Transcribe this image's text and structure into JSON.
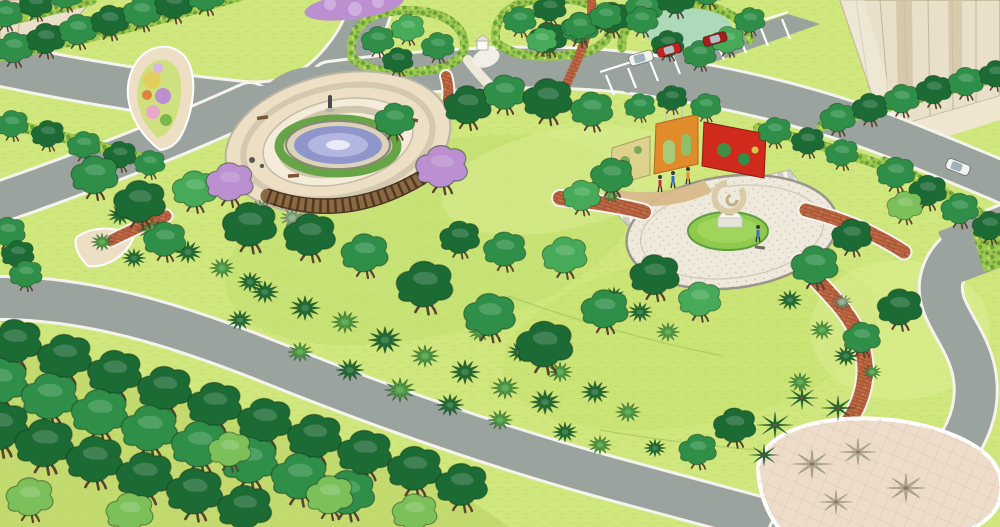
{
  "meta": {
    "domain": "landscape-architecture-render",
    "render_style": "sketchup-perspective-aerial",
    "image_width": 1000,
    "image_height": 527
  },
  "palette": {
    "white": "#f4f3ec",
    "road": "#9aa39d",
    "lawn": "#cfe77c",
    "lawnLight": "#dff09a",
    "lawnDark": "#b5d95f",
    "canopyDark": "#1c6b35",
    "canopyMid": "#2f8f48",
    "canopyBright": "#46aa58",
    "canopyLight": "#7cc05a",
    "canopyPale": "#a8d8c0",
    "trunk": "#5b4330",
    "hedge": "#9fc84e",
    "hedgeDark": "#5d9c3a",
    "shrubDark": "#226d36",
    "shrubMid": "#4f9e45",
    "shrubPale": "#8aa888",
    "shadow": "#a79e8b",
    "pavingTan": "#ecdfc4",
    "pavingLight": "#f4ecd9",
    "pavingRing": "#cfc6ae",
    "pavingGray": "#b7b2a2",
    "brick": "#bc6642",
    "brickLight": "#d08a5e",
    "water": "#8e96cc",
    "waterLight": "#b8bde4",
    "purple": "#bb8fd0",
    "purpleLight": "#d6b6e4",
    "pink": "#e8a8c8",
    "flowerYellow": "#e3cf5e",
    "wallCream": "#ddd28c",
    "wallOrange": "#e08c2a",
    "wallRed": "#cf2a1c",
    "sculpt": "#d9cba6",
    "sand": "#d8b98a",
    "building": "#e9e0ca",
    "buildingLine": "#b9ac8c",
    "buildingDark": "#cfc2a2",
    "carRed": "#c32323",
    "carDarkRed": "#a81d1d",
    "carWhite": "#f2f2ef",
    "plazaBottom": "#eddcca",
    "plazaGrid": "#d8c3ae"
  },
  "scene_elements": [
    {
      "name": "fountain-plaza",
      "desc": "circular paved plaza, round blue fountain with hedge ring, curved wooden pergola, teardrop flower bed, benches, small statue"
    },
    {
      "name": "sculpture-plaza",
      "desc": "oval paved plaza, ring sculpture on white pedestal in circular lawn, striped walkway, colorful perforated screen walls (cream, orange, red), sand play area with figures"
    },
    {
      "name": "south-plaza",
      "desc": "leaf-shaped paved plaza with diamond grid paving and palm shadows"
    },
    {
      "name": "ring-road",
      "desc": "grey loop road with white edge lines around the park"
    },
    {
      "name": "parking-bay",
      "desc": "white striped parking stalls with three parked cars"
    },
    {
      "name": "street-tree-rows",
      "desc": "hedge strips with evenly spaced street trees along roads"
    },
    {
      "name": "tree-grove",
      "desc": "dense staggered canopy-tree rows over light understory, bottom-left"
    },
    {
      "name": "office-building",
      "desc": "tall beige curtain-wall building, top-right corner"
    },
    {
      "name": "entry-building",
      "desc": "beige building corner, top-left"
    }
  ],
  "variant_colors": {
    "d": "canopyDark",
    "m": "canopyMid",
    "b": "canopyBright",
    "l": "canopyLight",
    "p": "shrubPale"
  },
  "vegetation": {
    "street_trees": [
      [
        14,
        50,
        0.8,
        "m"
      ],
      [
        46,
        41,
        0.8,
        "d"
      ],
      [
        78,
        32,
        0.8,
        "m"
      ],
      [
        110,
        23,
        0.8,
        "d"
      ],
      [
        142,
        14,
        0.8,
        "m"
      ],
      [
        174,
        6,
        0.8,
        "d"
      ],
      [
        206,
        -2,
        0.8,
        "m"
      ],
      [
        6,
        16,
        0.7,
        "m"
      ],
      [
        36,
        6,
        0.7,
        "d"
      ],
      [
        66,
        -3,
        0.7,
        "m"
      ],
      [
        12,
        126,
        0.7,
        "m"
      ],
      [
        48,
        136,
        0.7,
        "d"
      ],
      [
        84,
        147,
        0.7,
        "m"
      ],
      [
        120,
        157,
        0.7,
        "d"
      ],
      [
        150,
        165,
        0.65,
        "m"
      ],
      [
        8,
        234,
        0.75,
        "m"
      ],
      [
        18,
        256,
        0.7,
        "d"
      ],
      [
        26,
        276,
        0.7,
        "m"
      ],
      [
        548,
        40,
        0.8,
        "d"
      ],
      [
        580,
        30,
        0.8,
        "m"
      ],
      [
        612,
        20,
        0.8,
        "d"
      ],
      [
        644,
        10,
        0.8,
        "m"
      ],
      [
        676,
        1,
        0.8,
        "d"
      ],
      [
        708,
        -8,
        0.8,
        "m"
      ],
      [
        838,
        120,
        0.75,
        "m"
      ],
      [
        870,
        110,
        0.75,
        "d"
      ],
      [
        902,
        101,
        0.75,
        "m"
      ],
      [
        934,
        92,
        0.75,
        "d"
      ],
      [
        966,
        84,
        0.75,
        "m"
      ],
      [
        996,
        76,
        0.7,
        "d"
      ],
      [
        896,
        175,
        0.8,
        "m"
      ],
      [
        928,
        193,
        0.8,
        "d"
      ],
      [
        960,
        211,
        0.8,
        "m"
      ],
      [
        990,
        228,
        0.75,
        "d"
      ],
      [
        378,
        42,
        0.7,
        "m"
      ],
      [
        408,
        30,
        0.7,
        "b"
      ],
      [
        438,
        48,
        0.7,
        "m"
      ],
      [
        398,
        62,
        0.65,
        "d"
      ],
      [
        520,
        22,
        0.7,
        "m"
      ],
      [
        550,
        10,
        0.7,
        "d"
      ],
      [
        580,
        28,
        0.7,
        "m"
      ],
      [
        542,
        42,
        0.65,
        "b"
      ],
      [
        606,
        18,
        0.7,
        "m"
      ],
      [
        642,
        22,
        0.7,
        "m"
      ],
      [
        668,
        46,
        0.7,
        "d"
      ],
      [
        700,
        56,
        0.7,
        "m"
      ],
      [
        728,
        42,
        0.7,
        "b"
      ],
      [
        750,
        22,
        0.65,
        "m"
      ],
      [
        775,
        133,
        0.7,
        "m"
      ],
      [
        808,
        143,
        0.7,
        "d"
      ],
      [
        842,
        155,
        0.7,
        "m"
      ]
    ],
    "park_trees": [
      [
        468,
        108,
        1,
        "d"
      ],
      [
        505,
        95,
        0.9,
        "m"
      ],
      [
        548,
        102,
        1.05,
        "d"
      ],
      [
        592,
        112,
        0.9,
        "m"
      ],
      [
        395,
        122,
        0.85,
        "m"
      ],
      [
        640,
        108,
        0.65,
        "m"
      ],
      [
        672,
        100,
        0.65,
        "d"
      ],
      [
        706,
        108,
        0.65,
        "m"
      ],
      [
        95,
        178,
        1,
        "m"
      ],
      [
        140,
        205,
        1.1,
        "d"
      ],
      [
        195,
        192,
        0.95,
        "b"
      ],
      [
        250,
        228,
        1.15,
        "d"
      ],
      [
        165,
        242,
        0.9,
        "m"
      ],
      [
        310,
        238,
        1.1,
        "d"
      ],
      [
        365,
        256,
        1,
        "m"
      ],
      [
        425,
        288,
        1.2,
        "d"
      ],
      [
        490,
        318,
        1.1,
        "m"
      ],
      [
        545,
        348,
        1.2,
        "d"
      ],
      [
        605,
        312,
        1,
        "m"
      ],
      [
        655,
        278,
        1.05,
        "d"
      ],
      [
        700,
        302,
        0.9,
        "b"
      ],
      [
        565,
        258,
        0.95,
        "b"
      ],
      [
        505,
        252,
        0.9,
        "m"
      ],
      [
        460,
        240,
        0.85,
        "d"
      ],
      [
        612,
        178,
        0.9,
        "m"
      ],
      [
        582,
        198,
        0.8,
        "b"
      ],
      [
        815,
        268,
        1,
        "m"
      ],
      [
        852,
        238,
        0.85,
        "d"
      ],
      [
        735,
        428,
        0.9,
        "d"
      ],
      [
        698,
        452,
        0.8,
        "m"
      ],
      [
        900,
        310,
        0.95,
        "d"
      ],
      [
        862,
        340,
        0.8,
        "m"
      ],
      [
        905,
        208,
        0.75,
        "l"
      ]
    ],
    "purple_trees": [
      [
        230,
        185,
        1
      ],
      [
        442,
        170,
        1.1
      ]
    ],
    "grove_trees": [
      [
        15,
        345,
        1.15,
        "d"
      ],
      [
        65,
        360,
        1.15,
        "d"
      ],
      [
        115,
        376,
        1.15,
        "d"
      ],
      [
        165,
        392,
        1.15,
        "d"
      ],
      [
        215,
        408,
        1.15,
        "d"
      ],
      [
        265,
        424,
        1.15,
        "d"
      ],
      [
        315,
        440,
        1.15,
        "d"
      ],
      [
        365,
        456,
        1.15,
        "d"
      ],
      [
        415,
        472,
        1.15,
        "d"
      ],
      [
        462,
        488,
        1.1,
        "d"
      ],
      [
        0,
        385,
        1.2,
        "m"
      ],
      [
        50,
        400,
        1.2,
        "m"
      ],
      [
        100,
        416,
        1.2,
        "m"
      ],
      [
        150,
        432,
        1.2,
        "m"
      ],
      [
        200,
        448,
        1.2,
        "m"
      ],
      [
        250,
        464,
        1.2,
        "m"
      ],
      [
        300,
        480,
        1.2,
        "m"
      ],
      [
        348,
        496,
        1.15,
        "m"
      ],
      [
        0,
        430,
        1.25,
        "d"
      ],
      [
        45,
        447,
        1.25,
        "d"
      ],
      [
        95,
        463,
        1.2,
        "d"
      ],
      [
        145,
        479,
        1.2,
        "d"
      ],
      [
        195,
        495,
        1.2,
        "d"
      ],
      [
        245,
        511,
        1.15,
        "d"
      ],
      [
        30,
        500,
        1,
        "l"
      ],
      [
        130,
        515,
        1,
        "l"
      ],
      [
        230,
        452,
        0.9,
        "l"
      ],
      [
        330,
        498,
        1,
        "l"
      ],
      [
        415,
        515,
        0.95,
        "l"
      ]
    ],
    "shrubs": [
      [
        265,
        292,
        1,
        "d"
      ],
      [
        305,
        308,
        1.1,
        "d"
      ],
      [
        345,
        322,
        1,
        "m"
      ],
      [
        385,
        340,
        1.2,
        "d"
      ],
      [
        425,
        356,
        1,
        "m"
      ],
      [
        465,
        372,
        1.1,
        "d"
      ],
      [
        505,
        388,
        1,
        "m"
      ],
      [
        545,
        402,
        1.1,
        "d"
      ],
      [
        300,
        352,
        0.9,
        "m"
      ],
      [
        350,
        370,
        1,
        "d"
      ],
      [
        400,
        390,
        1.1,
        "m"
      ],
      [
        450,
        405,
        1,
        "d"
      ],
      [
        500,
        420,
        0.9,
        "m"
      ],
      [
        240,
        320,
        0.9,
        "d"
      ],
      [
        560,
        372,
        0.9,
        "m"
      ],
      [
        595,
        392,
        1,
        "d"
      ],
      [
        628,
        412,
        0.9,
        "m"
      ],
      [
        520,
        352,
        0.9,
        "d"
      ],
      [
        480,
        332,
        0.85,
        "m"
      ],
      [
        565,
        432,
        0.9,
        "d"
      ],
      [
        600,
        445,
        0.85,
        "m"
      ],
      [
        655,
        448,
        0.8,
        "d"
      ],
      [
        120,
        215,
        0.9,
        "d"
      ],
      [
        152,
        230,
        1,
        "m"
      ],
      [
        188,
        252,
        1,
        "d"
      ],
      [
        222,
        268,
        0.9,
        "m"
      ],
      [
        134,
        258,
        0.85,
        "d"
      ],
      [
        102,
        242,
        0.8,
        "m"
      ],
      [
        250,
        282,
        0.9,
        "d"
      ],
      [
        292,
        218,
        0.85,
        "p"
      ],
      [
        322,
        228,
        0.8,
        "p"
      ],
      [
        260,
        208,
        0.75,
        "p"
      ],
      [
        640,
        312,
        0.9,
        "d"
      ],
      [
        668,
        332,
        0.85,
        "m"
      ],
      [
        614,
        296,
        0.8,
        "d"
      ],
      [
        790,
        300,
        0.9,
        "d"
      ],
      [
        822,
        330,
        0.85,
        "m"
      ],
      [
        846,
        356,
        0.9,
        "d"
      ],
      [
        800,
        382,
        0.85,
        "m"
      ],
      [
        842,
        302,
        0.7,
        "p"
      ],
      [
        612,
        196,
        0.6,
        "m"
      ],
      [
        872,
        372,
        0.7,
        "m"
      ]
    ],
    "palms": [
      [
        775,
        425,
        1
      ],
      [
        802,
        398,
        0.9
      ],
      [
        838,
        408,
        0.95
      ],
      [
        764,
        455,
        0.85
      ]
    ],
    "palm_shadows": [
      [
        812,
        464,
        1.1
      ],
      [
        858,
        452,
        1
      ],
      [
        906,
        488,
        1.1
      ],
      [
        836,
        502,
        0.9
      ]
    ]
  },
  "people": [
    [
      660,
      184,
      "#c03030"
    ],
    [
      673,
      180,
      "#3a6ac8"
    ],
    [
      688,
      176,
      "#e08c2a"
    ],
    [
      758,
      234,
      "#3a6ac8"
    ]
  ],
  "vehicles": [
    {
      "x": 641,
      "y": 58,
      "rot": -16,
      "type": "van",
      "color": "carWhite"
    },
    {
      "x": 669,
      "y": 50,
      "rot": -16,
      "type": "car",
      "color": "carRed"
    },
    {
      "x": 715,
      "y": 39,
      "rot": -16,
      "type": "car",
      "color": "carDarkRed"
    },
    {
      "x": 958,
      "y": 167,
      "rot": 21,
      "type": "van",
      "color": "carWhite"
    }
  ]
}
